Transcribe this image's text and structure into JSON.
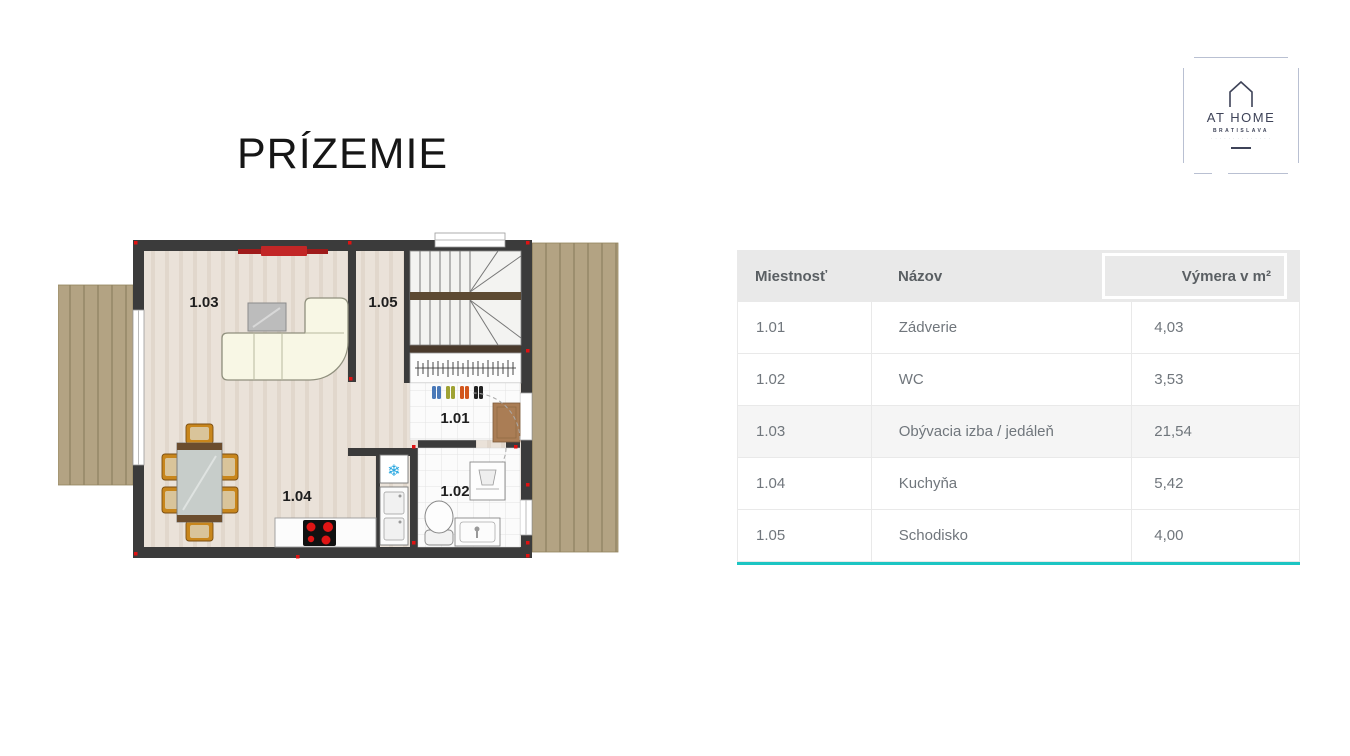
{
  "title": "PRÍZEMIE",
  "logo": {
    "brand": "AT HOME",
    "city": "BRATISLAVA",
    "fine_print": "· · · · · · · · · · · · · ·"
  },
  "icons": {
    "snowflake": "❄"
  },
  "plan": {
    "room_labels": {
      "r101": "1.01",
      "r102": "1.02",
      "r103": "1.03",
      "r104": "1.04",
      "r105": "1.05"
    }
  },
  "table": {
    "columns": [
      "Miestnosť",
      "Názov",
      "Výmera v m²"
    ],
    "rows": [
      [
        "1.01",
        "Zádverie",
        "4,03"
      ],
      [
        "1.02",
        "WC",
        "3,53"
      ],
      [
        "1.03",
        "Obývacia izba / jedáleň",
        "21,54"
      ],
      [
        "1.04",
        "Kuchyňa",
        "5,42"
      ],
      [
        "1.05",
        "Schodisko",
        "4,00"
      ]
    ],
    "accent_color": "#1cc5c3"
  }
}
